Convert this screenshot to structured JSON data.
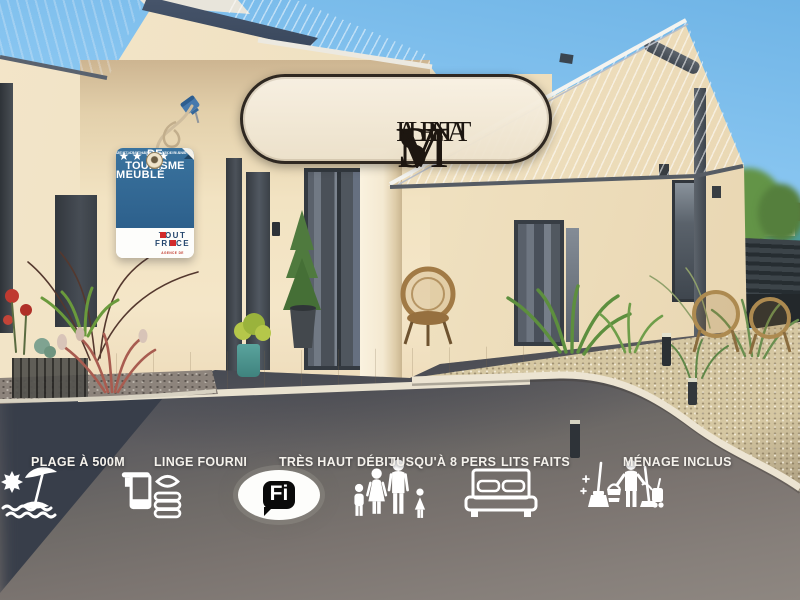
{
  "brand": {
    "name": "Villa Saint Mart",
    "parts": [
      {
        "cap": "V",
        "rest": "ILLA"
      },
      {
        "cap": "S",
        "rest": "AINT"
      },
      {
        "cap": "M",
        "rest": "ART"
      }
    ]
  },
  "badge": {
    "line1": "MEUBLÉ",
    "line2": "DE TOURISME",
    "stars": "★★★★",
    "fine_print_line1": "CE CLASSEMENT VALABLE 5 ANS",
    "fine_print_line2": "MENTION CHARGÉ DU TOURISME",
    "atout": {
      "t1": "TOUT",
      "t2a": "FR",
      "t2b": "NCE",
      "sub": "AGENCE DE DÉVELOPPEMENT TOURISTIQUE"
    }
  },
  "amenities": {
    "items": [
      {
        "icon": "beach-umbrella-icon",
        "label": "PLAGE À 500M"
      },
      {
        "icon": "towels-linens-icon",
        "label": "LINGE FOURNI"
      },
      {
        "icon": "wifi-icon",
        "label": "TRÈS HAUT DÉBIT"
      },
      {
        "icon": "family-icon",
        "label": "JUSQU'À 8 PERS"
      },
      {
        "icon": "bed-icon",
        "label": "LITS FAITS"
      },
      {
        "icon": "cleaning-icon",
        "label": "MÉNAGE INCLUS"
      }
    ],
    "wifi": {
      "wi": "Wi",
      "fi": "Fi"
    }
  },
  "colors": {
    "brand_cream": "#F3EAD6",
    "brand_dark": "#241C14",
    "badge_blue": "#2F6591",
    "atout_red": "#D22B2B",
    "atout_navy": "#24466E",
    "icon_white": "#FFFFFF",
    "wifi_black": "#0A0A0A",
    "sky_blue": "#8CC8F2",
    "roof_slate": "#3A4860",
    "roof_light": "#C4C9D3",
    "wall_cream": "#EFE0BF",
    "asphalt_dark": "#40454F",
    "asphalt_light": "#7D7672",
    "gravel_beige": "#D5C7A2"
  }
}
